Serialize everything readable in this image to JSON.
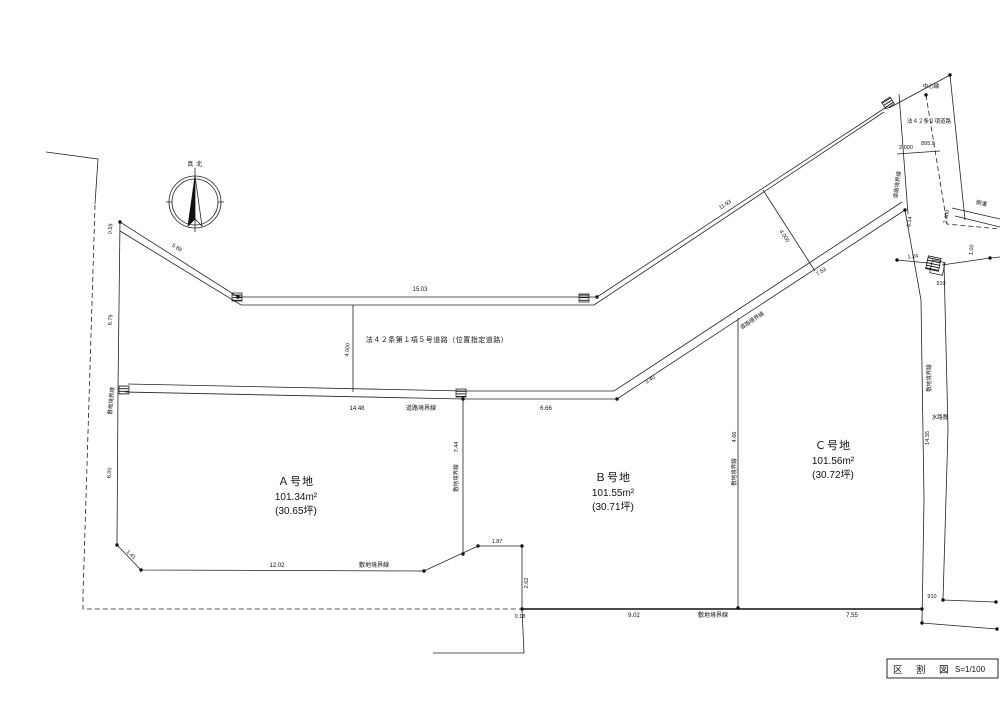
{
  "sheet": {
    "title": "区　割　図",
    "scale": "S=1/100"
  },
  "compass": {
    "label": "真 北"
  },
  "road": {
    "designation": "法４２条第１項５号道路（位置指定道路）",
    "secondary_road": "法４２条２項道路",
    "center_line": "中心線",
    "road_boundary_label": "道路境界線",
    "site_boundary_label": "敷地境界線",
    "waterway_label": "水路敷",
    "gutter_label": "側溝"
  },
  "lots": [
    {
      "name": "Ａ号地",
      "area": "101.34m²",
      "tsubo": "(30.65坪)"
    },
    {
      "name": "Ｂ号地",
      "area": "101.55m²",
      "tsubo": "(30.71坪)"
    },
    {
      "name": "Ｃ号地",
      "area": "101.56m²",
      "tsubo": "(30.72坪)"
    }
  ],
  "dimensions": {
    "west_top": "0.59",
    "west_upper": "6.79",
    "west_lower": "6.00",
    "nw_diagonal": "5.89",
    "north_run": "15.03",
    "ne_diagonal": "11.93",
    "road_width_mid": "4.000",
    "road_width_east": "4.000",
    "south_run_a": "14.48",
    "south_run_b": "6.66",
    "se_lower": "3.40",
    "se_upper": "7.53",
    "ab_depth": "7.44",
    "bc_depth": "4.66",
    "sw_corner": "1.41",
    "a_south": "12.02",
    "b_notch": "1.87",
    "b_side": "2.62",
    "b_offset": "0.18",
    "b_south": "9.02",
    "c_south": "7.55",
    "ne_setback": "2.000",
    "ne_value": "895.5",
    "ne_side": "6.14",
    "ne_width": "2.400",
    "ne_small": "1.00",
    "ne_corner": "1.24",
    "waterway_top": "910",
    "waterway_bottom": "910",
    "waterway_length": "14.35"
  }
}
